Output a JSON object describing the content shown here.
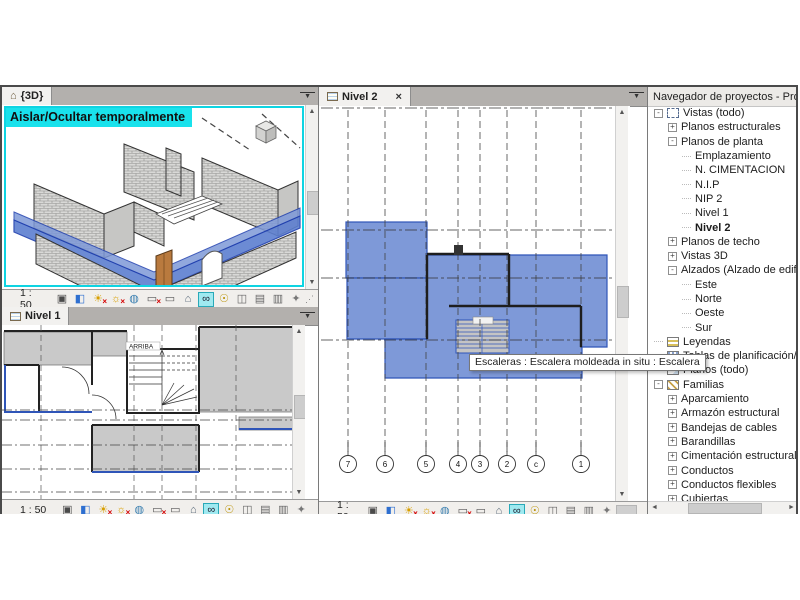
{
  "colors": {
    "accent_cyan": "#19e2ec",
    "selection_blue": "#7e99d8",
    "selection_blue_dark": "#2f55b8",
    "tab_bar_bg": "#b3b0ad",
    "active_tab_bg": "#f2f1ef",
    "plan_gray": "#c9c9c9"
  },
  "views": {
    "view3d": {
      "tab": "{3D}",
      "banner": "Aislar/Ocultar temporalmente",
      "scale": "1 : 50"
    },
    "nivel1": {
      "tab": "Nivel 1",
      "stair_label": "ARRIBA",
      "scale": "1 : 50"
    },
    "nivel2": {
      "tab": "Nivel 2",
      "close": "×",
      "scale": "1 : 50",
      "tooltip": "Escaleras : Escalera moldeada in situ : Escalera",
      "grid_bubbles": [
        "7",
        "6",
        "5",
        "4",
        "3",
        "2",
        "c",
        "1"
      ]
    }
  },
  "browser": {
    "title": "Navegador de proyectos - Proyec...",
    "tree": [
      {
        "label": "Vistas (todo)",
        "level": 0,
        "exp": "-",
        "icon": "views"
      },
      {
        "label": "Planos estructurales",
        "level": 1,
        "exp": "+"
      },
      {
        "label": "Planos de planta",
        "level": 1,
        "exp": "-"
      },
      {
        "label": "Emplazamiento",
        "level": 2
      },
      {
        "label": "N. CIMENTACION",
        "level": 2
      },
      {
        "label": "N.I.P",
        "level": 2
      },
      {
        "label": "NIP 2",
        "level": 2
      },
      {
        "label": "Nivel 1",
        "level": 2
      },
      {
        "label": "Nivel 2",
        "level": 2,
        "bold": true
      },
      {
        "label": "Planos de techo",
        "level": 1,
        "exp": "+"
      },
      {
        "label": "Vistas 3D",
        "level": 1,
        "exp": "+"
      },
      {
        "label": "Alzados (Alzado de edificio",
        "level": 1,
        "exp": "-"
      },
      {
        "label": "Este",
        "level": 2
      },
      {
        "label": "Norte",
        "level": 2
      },
      {
        "label": "Oeste",
        "level": 2
      },
      {
        "label": "Sur",
        "level": 2
      },
      {
        "label": "Leyendas",
        "level": 0,
        "icon": "legend"
      },
      {
        "label": "Tablas de planificación/Canti",
        "level": 0,
        "icon": "schedule"
      },
      {
        "label": "Planos (todo)",
        "level": 0,
        "icon": "sheet"
      },
      {
        "label": "Familias",
        "level": 0,
        "exp": "-",
        "icon": "family"
      },
      {
        "label": "Aparcamiento",
        "level": 1,
        "exp": "+"
      },
      {
        "label": "Armazón estructural",
        "level": 1,
        "exp": "+"
      },
      {
        "label": "Bandejas de cables",
        "level": 1,
        "exp": "+"
      },
      {
        "label": "Barandillas",
        "level": 1,
        "exp": "+"
      },
      {
        "label": "Cimentación estructural",
        "level": 1,
        "exp": "+"
      },
      {
        "label": "Conductos",
        "level": 1,
        "exp": "+"
      },
      {
        "label": "Conductos flexibles",
        "level": 1,
        "exp": "+"
      },
      {
        "label": "Cubiertas",
        "level": 1,
        "exp": "+"
      }
    ]
  },
  "viewbar_icons": [
    {
      "name": "visual-style-icon",
      "glyph": "▣",
      "color": "#4a4a4a"
    },
    {
      "name": "shaded-view-icon",
      "glyph": "◧",
      "color": "#2e6fd0"
    },
    {
      "name": "shadows-off-icon",
      "glyph": "☀",
      "color": "#d89f00",
      "badge": "×"
    },
    {
      "name": "sun-path-off-icon",
      "glyph": "☼",
      "color": "#d89f00",
      "badge": "×"
    },
    {
      "name": "render-icon",
      "glyph": "◍",
      "color": "#3a7fb0"
    },
    {
      "name": "crop-off-icon",
      "glyph": "▭",
      "color": "#555555",
      "badge": "×"
    },
    {
      "name": "crop-region-icon",
      "glyph": "▭",
      "color": "#555555"
    },
    {
      "name": "lock-view-icon",
      "glyph": "⌂",
      "color": "#556677"
    },
    {
      "name": "temporary-hide-isolate-icon",
      "glyph": "∞",
      "color": "#222233",
      "active": true
    },
    {
      "name": "reveal-hidden-icon",
      "glyph": "☉",
      "color": "#b89000"
    },
    {
      "name": "worksharing-icon",
      "glyph": "◫",
      "color": "#666666"
    },
    {
      "name": "displace-icon",
      "glyph": "▤",
      "color": "#666666"
    },
    {
      "name": "constraints-icon",
      "glyph": "▥",
      "color": "#666666"
    },
    {
      "name": "properties-icon",
      "glyph": "✦",
      "color": "#777777"
    }
  ]
}
